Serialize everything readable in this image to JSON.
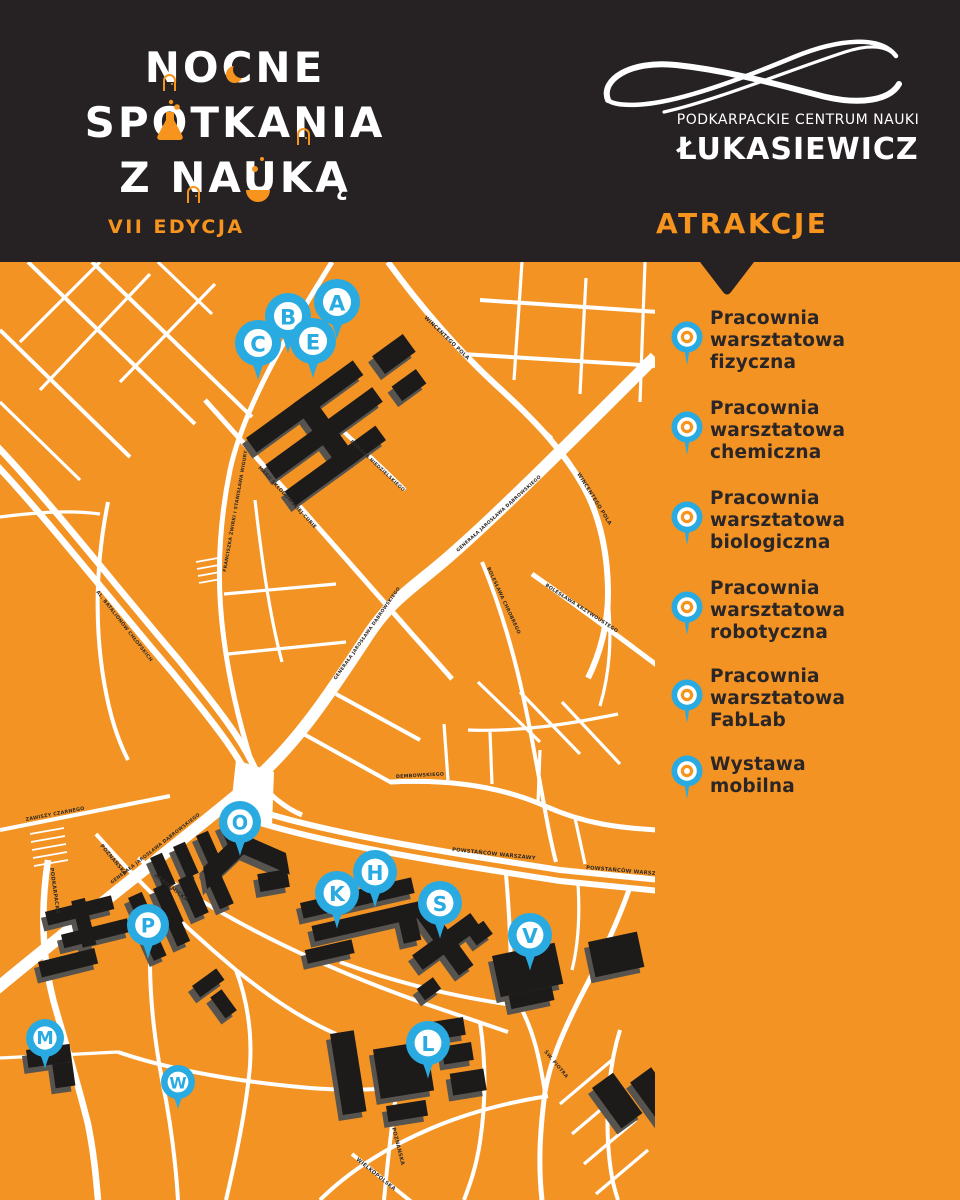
{
  "header": {
    "title_lines": [
      "NOCNE",
      "SPOTKANIA",
      "Z NAUKĄ"
    ],
    "edition": "VII EDYCJA",
    "org_name_top": "PODKARPACKIE CENTRUM NAUKI",
    "org_name_bottom": "ŁUKASIEWICZ",
    "attractions_heading": "ATRAKCJE"
  },
  "colors": {
    "background_orange": "#F39323",
    "accent_orange": "#F7941E",
    "header_dark": "#262223",
    "pin_blue": "#29ABE2",
    "road_white": "#FFFFFF",
    "building_black": "#1D1B1A",
    "building_shadow": "#57544F",
    "text_dark": "#2A2526"
  },
  "legend": {
    "items": [
      {
        "icon": "map-pin",
        "lines": [
          "Pracownia",
          "warsztatowa",
          "fizyczna"
        ]
      },
      {
        "icon": "map-pin",
        "lines": [
          "Pracownia",
          "warsztatowa",
          "chemiczna"
        ]
      },
      {
        "icon": "map-pin",
        "lines": [
          "Pracownia",
          "warsztatowa",
          "biologiczna"
        ]
      },
      {
        "icon": "map-pin",
        "lines": [
          "Pracownia",
          "warsztatowa",
          "robotyczna"
        ]
      },
      {
        "icon": "map-pin",
        "lines": [
          "Pracownia",
          "warsztatowa",
          "FabLab"
        ]
      },
      {
        "icon": "map-pin",
        "lines": [
          "Wystawa",
          "mobilna"
        ]
      }
    ]
  },
  "map": {
    "pins": [
      {
        "letter": "A",
        "x": 337,
        "y": 40,
        "r": 23
      },
      {
        "letter": "B",
        "x": 288,
        "y": 54,
        "r": 23
      },
      {
        "letter": "C",
        "x": 258,
        "y": 81,
        "r": 23
      },
      {
        "letter": "E",
        "x": 313,
        "y": 79,
        "r": 23
      },
      {
        "letter": "O",
        "x": 240,
        "y": 560,
        "r": 21
      },
      {
        "letter": "P",
        "x": 148,
        "y": 663,
        "r": 21
      },
      {
        "letter": "M",
        "x": 45,
        "y": 776,
        "r": 19
      },
      {
        "letter": "W",
        "x": 178,
        "y": 820,
        "r": 17
      },
      {
        "letter": "K",
        "x": 337,
        "y": 631,
        "r": 22
      },
      {
        "letter": "H",
        "x": 375,
        "y": 610,
        "r": 22
      },
      {
        "letter": "S",
        "x": 440,
        "y": 641,
        "r": 22
      },
      {
        "letter": "V",
        "x": 530,
        "y": 673,
        "r": 22
      },
      {
        "letter": "L",
        "x": 428,
        "y": 781,
        "r": 22
      }
    ],
    "street_labels": [
      {
        "text": "WINCENTEGO POLA",
        "x": 424,
        "y": 56,
        "a": 44,
        "s": 5.2
      },
      {
        "text": "WINCENTEGO POLA",
        "x": 577,
        "y": 212,
        "a": 58,
        "s": 5.2
      },
      {
        "text": "FRANCISZKA ŻWIRKI I STANISŁAWA WIGURY",
        "x": 226,
        "y": 310,
        "a": -80,
        "s": 4.6
      },
      {
        "text": "MARII SKŁODOWSKIEJ-CURIE",
        "x": 258,
        "y": 206,
        "a": 47,
        "s": 4.8
      },
      {
        "text": "ROMANA NIEDZIELSKIEGO",
        "x": 350,
        "y": 180,
        "a": 43,
        "s": 4.6
      },
      {
        "text": "GENERAŁA JAROSŁAWA DĄBROWSKIEGO",
        "x": 458,
        "y": 290,
        "a": -42,
        "s": 4.6
      },
      {
        "text": "GENERAŁA JAROSŁAWA DĄBROWSKIEGO",
        "x": 336,
        "y": 418,
        "a": -55,
        "s": 4.6
      },
      {
        "text": "GENERAŁA JAROSŁAWA DĄBROWSKIEGO",
        "x": 112,
        "y": 622,
        "a": -38,
        "s": 4.6
      },
      {
        "text": "AL. BATALIONÓW CHŁOPSKICH",
        "x": 96,
        "y": 330,
        "a": 52,
        "s": 4.8
      },
      {
        "text": "ZAWISZY CZARNEGO",
        "x": 26,
        "y": 559,
        "a": -11,
        "s": 4.8
      },
      {
        "text": "PODKARPACKA",
        "x": 50,
        "y": 606,
        "a": 82,
        "s": 5.2
      },
      {
        "text": "BOLESŁAWA CHROBREGO",
        "x": 487,
        "y": 306,
        "a": 65,
        "s": 4.8
      },
      {
        "text": "BOLESŁAWA KRZYWOUSTEGO",
        "x": 545,
        "y": 324,
        "a": 33,
        "s": 4.8
      },
      {
        "text": "DEMBOWSKIEGO",
        "x": 396,
        "y": 516,
        "a": -3,
        "s": 4.8
      },
      {
        "text": "POWSTAŃCÓW WARSZAWY",
        "x": 452,
        "y": 589,
        "a": 6,
        "s": 5.2
      },
      {
        "text": "POWSTAŃCÓW WARSZAWY",
        "x": 586,
        "y": 607,
        "a": 5,
        "s": 5.2
      },
      {
        "text": "POZNAŃSKA",
        "x": 100,
        "y": 584,
        "a": 50,
        "s": 5.2
      },
      {
        "text": "AKADEMICKA",
        "x": 154,
        "y": 614,
        "a": 38,
        "s": 5.2
      },
      {
        "text": "POZNAŃSKA",
        "x": 392,
        "y": 866,
        "a": 76,
        "s": 5.2
      },
      {
        "text": "WIELKOPOLSKA",
        "x": 356,
        "y": 898,
        "a": 39,
        "s": 5.2
      },
      {
        "text": "ŚW. PIOTRA",
        "x": 544,
        "y": 790,
        "a": 50,
        "s": 4.8
      }
    ]
  }
}
